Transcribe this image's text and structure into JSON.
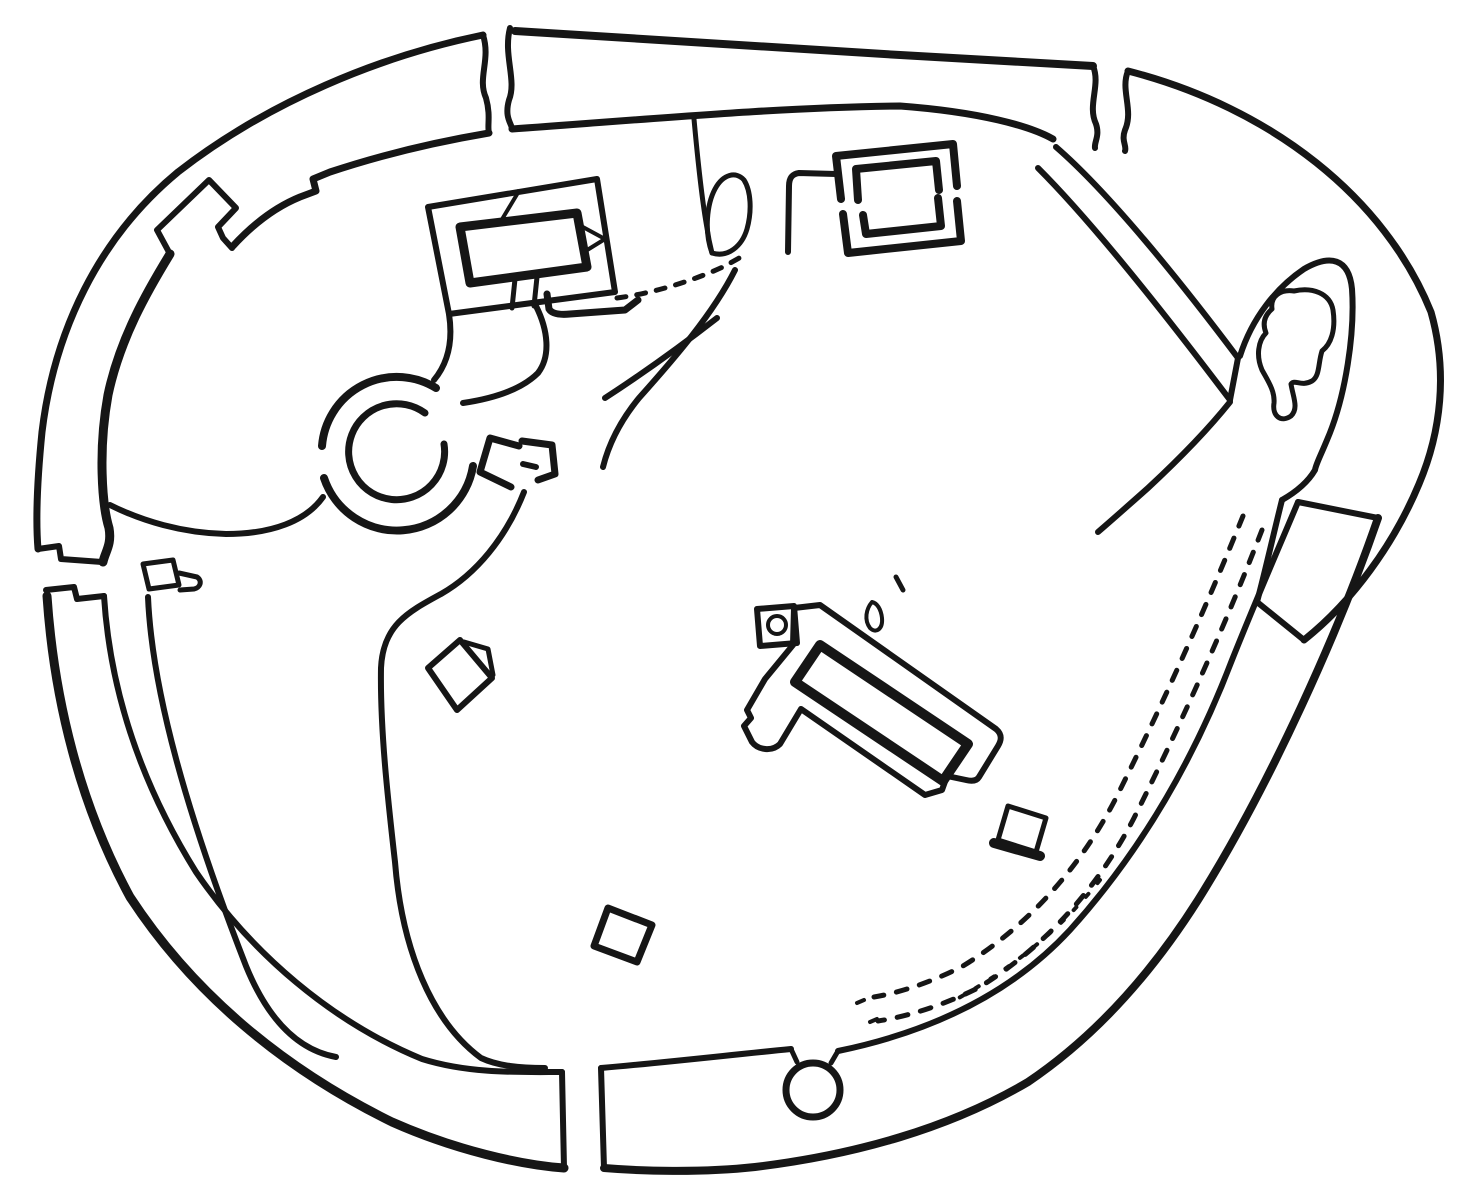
{
  "canvas": {
    "width": 1463,
    "height": 1184,
    "background": "#ffffff",
    "ink": "#161616"
  },
  "figure": {
    "kind": "archaeological-site-plan",
    "description": "Line-drawn plan of an irregular oval walled enclosure with four entrance gaps, an inner round structure with attached passage, rectangular buildings, a long central hall, a corner chamber with irregular blob, dashed trackways and interior hollow-way paths"
  },
  "features": [
    {
      "name": "outer-wall-top",
      "kind": "path",
      "d": "M 515,31 C 700,42 900,56 1093,66",
      "w": 8
    },
    {
      "name": "top-wall-right-endcap",
      "kind": "path",
      "d": "M 510,28 C 503,55 517,80 509,100 C 504,118 512,124 512,129",
      "w": 6
    },
    {
      "name": "inner-wall-top",
      "kind": "path",
      "d": "M 512,129 C 640,120 780,107 900,106 C 980,112 1030,126 1053,139",
      "w": 7
    },
    {
      "name": "nw-wall-endcap",
      "kind": "path",
      "d": "M 483,35 C 491,60 477,78 486,98 C 491,116 487,126 489,133",
      "w": 6
    },
    {
      "name": "outer-wall-nw",
      "kind": "path",
      "d": "M 483,35 C 380,56 268,102 178,172 C 98,238 54,332 42,432 C 36,492 36,525 38,549",
      "w": 7
    },
    {
      "name": "inner-wall-nw",
      "kind": "path",
      "d": "M 489,133 C 430,143 378,156 330,172 L 313,179 L 316,191 L 300,197 C 278,206 255,222 233,246",
      "w": 7
    },
    {
      "name": "wall-annex-t-structure",
      "kind": "path",
      "d": "M 232,248 L 223,238 L 218,227 L 236,208 L 209,180 L 157,230 L 170,254",
      "w": 6
    },
    {
      "name": "inner-wall-west-thick",
      "kind": "path",
      "d": "M 170,254 C 148,290 120,338 108,395 C 98,450 102,505 109,528 C 112,545 105,552 103,562",
      "w": 9
    },
    {
      "name": "west-gate-upper-cap",
      "kind": "path",
      "d": "M 38,549 L 59,546 L 61,559 L 102,562",
      "w": 6
    },
    {
      "name": "west-gate-tongue-block",
      "kind": "path",
      "d": "M 143,564 L 173,560 L 179,585 L 149,589 Z",
      "w": 5
    },
    {
      "name": "west-gate-tongue-finger",
      "kind": "path",
      "d": "M 179,573 L 197,577 C 203,581 200,588 194,589 L 180,590",
      "w": 5
    },
    {
      "name": "sw-wall-start-step",
      "kind": "path",
      "d": "M 46,590 L 74,587 L 77,599 L 104,596",
      "w": 6
    },
    {
      "name": "outer-wall-sw",
      "kind": "path",
      "d": "M 47,596 C 54,700 80,805 130,897 C 192,992 282,1068 392,1122 C 455,1150 521,1165 564,1168",
      "w": 9
    },
    {
      "name": "south-gap-left-cap",
      "kind": "path",
      "d": "M 564,1168 L 562,1072",
      "w": 6
    },
    {
      "name": "inner-wall-sw",
      "kind": "path",
      "d": "M 104,596 C 110,690 140,782 196,872 C 252,954 332,1022 422,1059 C 470,1074 520,1072 562,1072",
      "w": 6
    },
    {
      "name": "south-gap-right-cap",
      "kind": "path",
      "d": "M 601,1068 L 604,1168",
      "w": 6
    },
    {
      "name": "inner-wall-south",
      "kind": "path",
      "d": "M 601,1068 C 660,1063 730,1055 791,1049",
      "w": 6
    },
    {
      "name": "well-neck-left",
      "kind": "path",
      "d": "M 791,1049 L 797,1062",
      "w": 5
    },
    {
      "name": "well-neck-right",
      "kind": "path",
      "d": "M 838,1051 L 831,1063",
      "w": 5
    },
    {
      "name": "well-circle",
      "kind": "circle",
      "cx": 813,
      "cy": 1090,
      "r": 27,
      "w": 7
    },
    {
      "name": "inner-wall-south-east",
      "kind": "path",
      "d": "M 838,1051 C 930,1032 1010,995 1070,930 C 1135,858 1190,770 1232,660 C 1258,595 1280,545 1298,502",
      "w": 6
    },
    {
      "name": "se-wall-top-cap",
      "kind": "path",
      "d": "M 1298,502 L 1378,518",
      "w": 6
    },
    {
      "name": "outer-wall-se",
      "kind": "path",
      "d": "M 1378,518 C 1340,628 1272,782 1198,900 C 1160,960 1105,1030 1028,1082 C 950,1128 855,1155 755,1167 C 700,1173 640,1171 604,1168",
      "w": 8
    },
    {
      "name": "outer-wall-ne",
      "kind": "path",
      "d": "M 1128,71 C 1272,108 1385,198 1431,312 C 1448,372 1441,432 1419,484 C 1394,544 1352,602 1304,640",
      "w": 7
    },
    {
      "name": "ne-gap-left-cap",
      "kind": "path",
      "d": "M 1093,66 C 1101,85 1087,105 1096,124 C 1100,136 1094,142 1095,148",
      "w": 6
    },
    {
      "name": "ne-gap-right-cap",
      "kind": "path",
      "d": "M 1128,71 C 1120,90 1134,110 1125,130 C 1121,141 1127,146 1125,151",
      "w": 6
    },
    {
      "name": "ne-inner-berm-line-a",
      "kind": "path",
      "d": "M 1056,147 C 1108,192 1178,278 1238,358",
      "w": 6
    },
    {
      "name": "ne-inner-berm-line-b",
      "kind": "path",
      "d": "M 1038,168 C 1090,220 1162,310 1230,400",
      "w": 6
    },
    {
      "name": "ne-berm-endcap",
      "kind": "path",
      "d": "M 1238,358 L 1230,400",
      "w": 6
    },
    {
      "name": "ne-corner-chamber",
      "kind": "path",
      "d": "M 1240,356 C 1252,318 1276,288 1304,269 C 1330,254 1349,258 1352,289 C 1355,332 1346,396 1327,440 C 1320,457 1316,464 1315,470 C 1308,482 1296,492 1282,500",
      "w": 6
    },
    {
      "name": "ne-chamber-to-endcap",
      "kind": "path",
      "d": "M 1282,500 C 1273,536 1265,572 1257,602",
      "w": 6
    },
    {
      "name": "ne-wall-endcap",
      "kind": "path",
      "d": "M 1257,602 L 1304,640",
      "w": 6
    },
    {
      "name": "ne-chamber-crossline",
      "kind": "path",
      "d": "M 1230,402 C 1206,432 1176,462 1148,488 C 1130,504 1112,520 1098,532",
      "w": 6
    },
    {
      "name": "chamber-blob",
      "kind": "path",
      "d": "M 1272,309 C 1270,296 1281,289 1294,291 C 1312,287 1330,293 1333,310 C 1336,330 1331,344 1322,351 C 1318,363 1320,376 1312,381 C 1301,387 1295,379 1291,384 C 1293,397 1299,408 1291,416 C 1281,423 1272,416 1274,403 C 1275,391 1268,381 1262,370 C 1256,356 1258,341 1266,333 C 1262,323 1265,315 1272,309 Z",
      "w": 5
    },
    {
      "name": "dashed-track-outer",
      "kind": "path",
      "d": "M 1262,530 C 1228,618 1185,716 1134,818 C 1098,888 1044,948 978,988 C 942,1006 905,1017 878,1021",
      "w": 5,
      "dash": "11 13"
    },
    {
      "name": "dashed-track-inner",
      "kind": "path",
      "d": "M 1243,516 C 1208,602 1166,698 1116,798 C 1080,868 1028,926 963,966 C 930,983 898,993 874,997",
      "w": 5,
      "dash": "11 13"
    },
    {
      "name": "dash-dot-track",
      "kind": "path",
      "d": "M 1100,880 C 1060,930 1010,970 955,1000",
      "w": 4,
      "dash": "4 14"
    },
    {
      "name": "stray-dots",
      "kind": "path",
      "d": "M 857,1003 l 7,-3 M 870,1022 l 7,-3 M 884,1040 l 7,-3",
      "w": 4
    },
    {
      "name": "dotted-path-north",
      "kind": "path",
      "d": "M 617,298 C 655,293 695,280 725,266 L 741,257",
      "w": 5,
      "dash": "9 11"
    },
    {
      "name": "tree-stem",
      "kind": "path",
      "d": "M 694,119 C 697,152 701,195 707,228 C 709,242 711,249 712,253",
      "w": 5
    },
    {
      "name": "tree-leaf",
      "kind": "path",
      "d": "M 712,253 C 704,231 707,204 715,189 C 723,174 736,171 744,180 C 751,191 752,211 747,229 C 742,246 728,258 712,253 Z",
      "w": 5
    },
    {
      "name": "north-building-connector",
      "kind": "path",
      "d": "M 836,174 L 799,173 C 792,174 789,178 789,186 L 788,252",
      "w": 6
    },
    {
      "name": "north-building-top-outer",
      "kind": "path",
      "d": "M 841,199 L 836,156 L 953,144 L 957,186",
      "w": 8
    },
    {
      "name": "north-building-top-inner",
      "kind": "path",
      "d": "M 858,200 L 856,169 L 936,161 L 939,190",
      "w": 8
    },
    {
      "name": "north-building-bottom-outer",
      "kind": "path",
      "d": "M 843,214 L 848,253 L 961,241 L 957,201",
      "w": 8
    },
    {
      "name": "north-building-bottom-inner",
      "kind": "path",
      "d": "M 863,215 L 866,234 L 941,226 L 938,198",
      "w": 8
    },
    {
      "name": "nw-building-outer",
      "kind": "path",
      "d": "M 428,207 L 597,179 L 615,292 L 449,314 Z",
      "w": 6
    },
    {
      "name": "nw-building-inner-thick",
      "kind": "path",
      "d": "M 460,227 L 577,213 L 587,267 L 470,283 Z",
      "w": 9
    },
    {
      "name": "nw-building-door-left",
      "kind": "path",
      "d": "M 515,279 L 512,308",
      "w": 5
    },
    {
      "name": "nw-building-door-right",
      "kind": "path",
      "d": "M 537,277 L 534,306",
      "w": 5
    },
    {
      "name": "nw-building-triangle-top",
      "kind": "path",
      "d": "M 494,197 L 519,191 L 501,221",
      "w": 4
    },
    {
      "name": "nw-building-triangle-right",
      "kind": "path",
      "d": "M 581,226 L 605,239 L 584,252",
      "w": 4
    },
    {
      "name": "nw-building-annex-line",
      "kind": "path",
      "d": "M 547,294 L 549,309 C 552,314 560,315 570,314 L 625,310 L 638,300",
      "w": 7
    },
    {
      "name": "corridor-left",
      "kind": "path",
      "d": "M 449,314 C 453,340 449,362 434,380",
      "w": 6
    },
    {
      "name": "corridor-right",
      "kind": "path",
      "d": "M 536,306 C 548,330 551,356 538,373 C 520,391 490,399 463,403",
      "w": 6
    },
    {
      "name": "ring-outer-upper-arc",
      "kind": "path",
      "d": "M 322,446 A 75 75 0 0 1 436,388",
      "w": 8
    },
    {
      "name": "ring-outer-lower-arc",
      "kind": "path",
      "d": "M 324,478 A 77 77 0 0 0 473,466",
      "w": 8
    },
    {
      "name": "ring-inner-circle",
      "kind": "path",
      "d": "M 444,444 A 48 48 0 1 1 425,413",
      "w": 7
    },
    {
      "name": "ring-annex-bracket-left",
      "kind": "path",
      "d": "M 519,446 L 490,438 L 480,472 L 511,487",
      "w": 7
    },
    {
      "name": "ring-annex-bracket-right",
      "kind": "path",
      "d": "M 522,441 L 552,445 L 555,474 L 538,480",
      "w": 7
    },
    {
      "name": "ring-annex-notch",
      "kind": "path",
      "d": "M 536,467 L 523,464",
      "w": 6
    },
    {
      "name": "path-west-gate-to-ring",
      "kind": "path",
      "d": "M 110,505 C 142,521 182,533 226,534 C 272,534 306,521 323,497",
      "w": 6
    },
    {
      "name": "hollow-way-left",
      "kind": "path",
      "d": "M 148,597 C 152,690 186,812 246,966 C 268,1020 298,1050 336,1057",
      "w": 6
    },
    {
      "name": "hollow-way-right",
      "kind": "path",
      "d": "M 524,492 C 506,538 476,574 441,594 C 408,612 383,625 381,668 C 380,730 388,800 395,862 C 402,950 432,1022 481,1058 C 498,1066 520,1068 545,1068",
      "w": 6
    },
    {
      "name": "interior-s-curve-path",
      "kind": "path",
      "d": "M 735,270 C 713,314 673,360 639,398 C 621,420 609,443 603,467",
      "w": 6
    },
    {
      "name": "interior-straight-path",
      "kind": "path",
      "d": "M 605,398 C 642,374 681,346 717,318",
      "w": 6
    },
    {
      "name": "small-structure-square",
      "kind": "path",
      "d": "M 460,640 L 492,678 L 457,710 L 428,668 Z",
      "w": 6
    },
    {
      "name": "small-structure-flap",
      "kind": "path",
      "d": "M 464,642 L 488,649 L 493,675",
      "w": 5
    },
    {
      "name": "small-diamond",
      "kind": "path",
      "d": "M 608,908 L 652,925 L 637,962 L 594,946 Z",
      "w": 7
    },
    {
      "name": "central-hall-outer",
      "kind": "path",
      "d": "M 794,608 L 820,605 L 996,729 C 1003,735 1001,741 998,746 L 979,777 C 976,782 970,781 966,780 L 947,776 L 942,790 L 925,795 L 801,709 L 780,744 C 772,752 758,750 752,742 L 744,726 L 751,718 L 747,710 L 765,679 L 793,645 Z",
      "w": 6
    },
    {
      "name": "central-hall-inner-thick",
      "kind": "path",
      "d": "M 820,645 L 968,744 L 943,781 L 795,682 Z",
      "w": 10
    },
    {
      "name": "hearth-square",
      "kind": "path",
      "d": "M 757,609 L 794,606 L 797,643 L 760,646 Z",
      "w": 6
    },
    {
      "name": "hearth-circle",
      "kind": "circle",
      "cx": 777,
      "cy": 625,
      "r": 9,
      "w": 4
    },
    {
      "name": "comma-mark",
      "kind": "path",
      "d": "M 872,602 C 866,609 864,620 870,628 C 876,634 883,629 882,618 C 881,609 877,603 872,602 Z",
      "w": 4
    },
    {
      "name": "tick-mark",
      "kind": "path",
      "d": "M 896,577 L 903,590",
      "w": 5
    },
    {
      "name": "small-structure-se-square",
      "kind": "path",
      "d": "M 1008,806 L 1046,818 L 1036,852 L 998,840 Z",
      "w": 5
    },
    {
      "name": "small-structure-se-bar",
      "kind": "path",
      "d": "M 994,843 L 1040,856",
      "w": 10
    }
  ]
}
